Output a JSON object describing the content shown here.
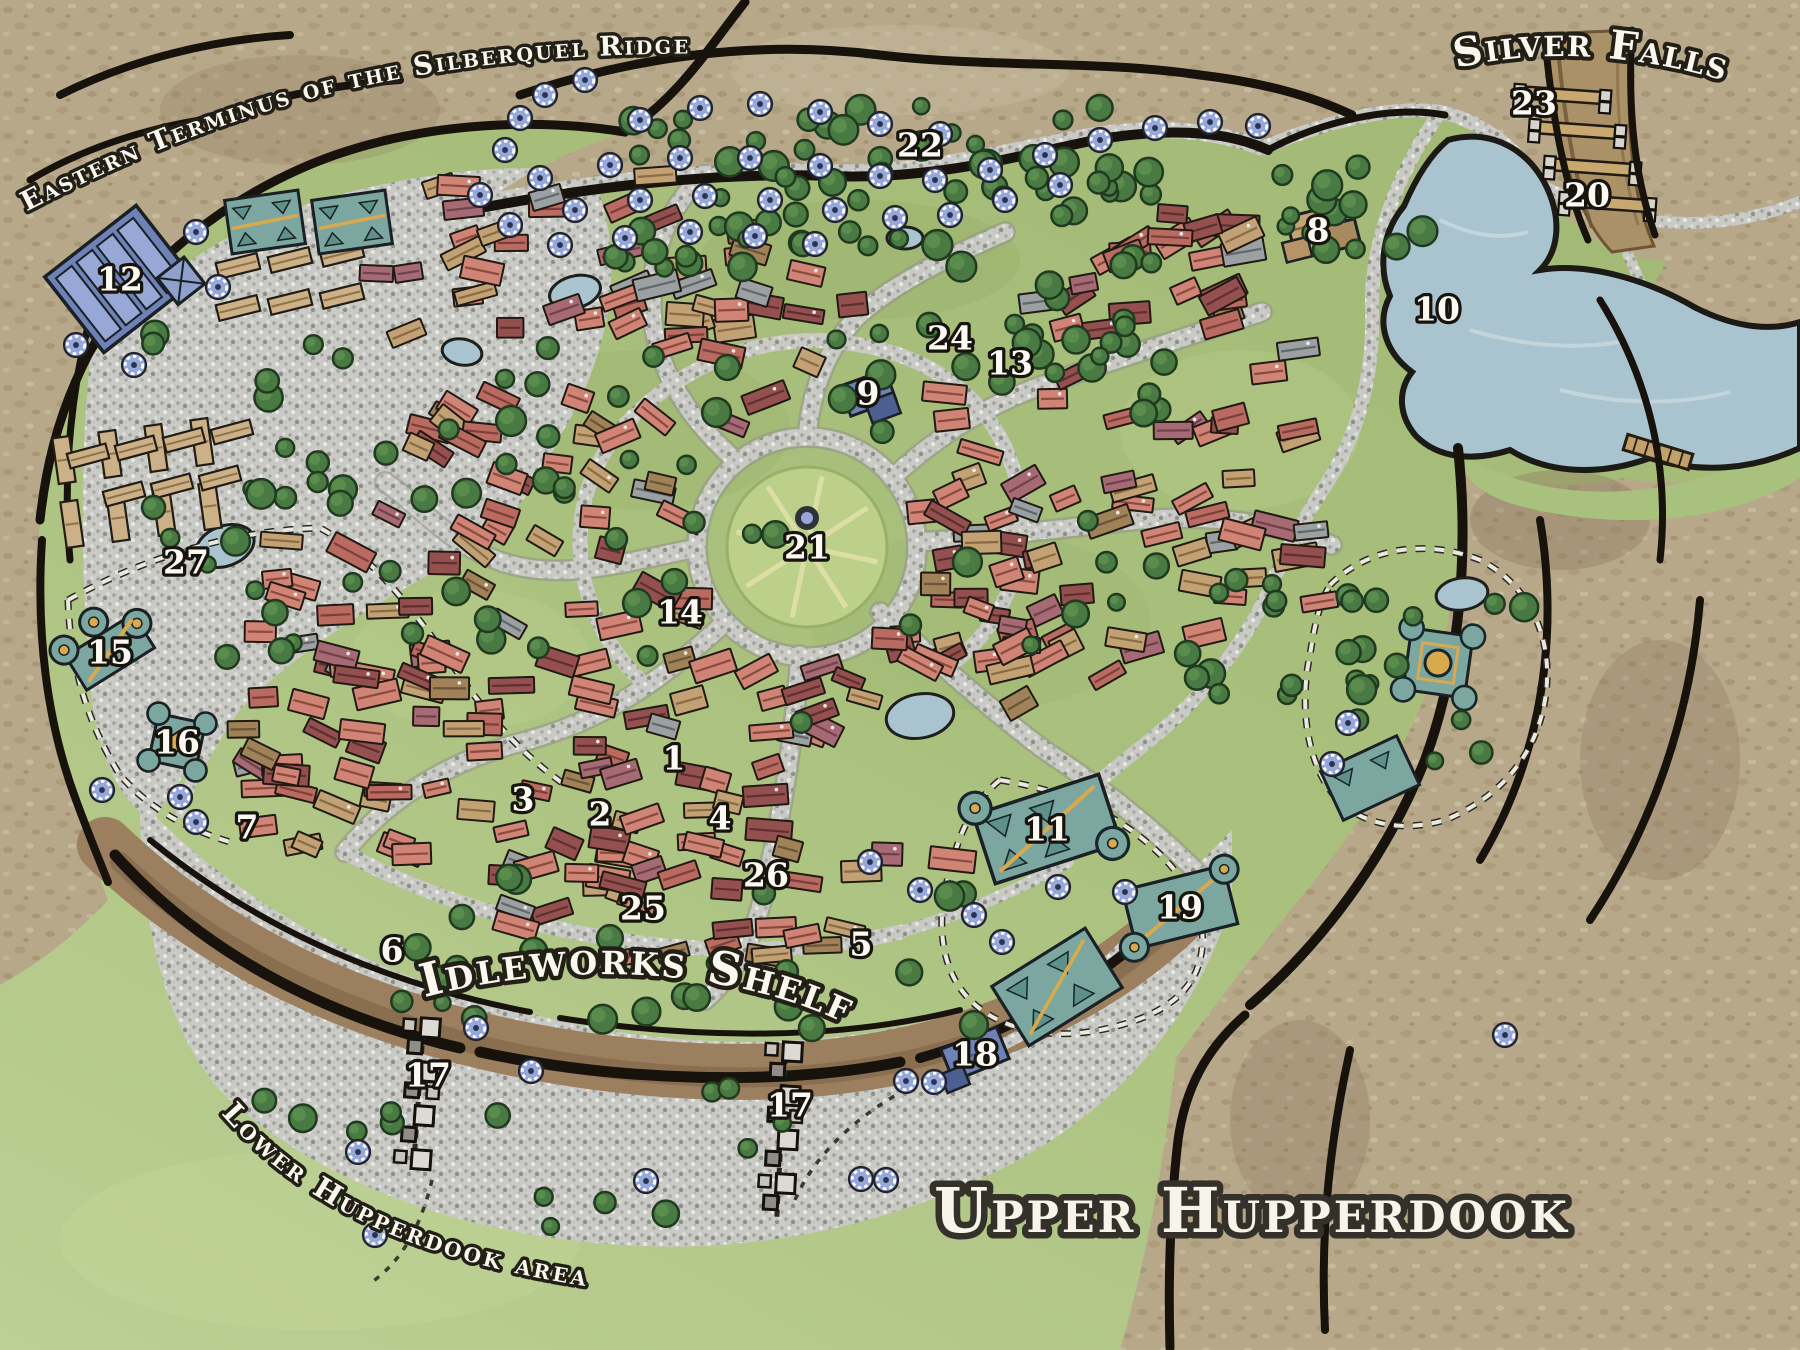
{
  "map": {
    "title": "Upper Hupperdook",
    "labels": {
      "eastern_terminus": "Eastern Terminus of the Silberquel Ridge",
      "silver_falls": "Silver Falls",
      "idleworks_shelf": "Idleworks Shelf",
      "lower_hupperdook": "Lower Hupperdook area"
    },
    "markers": [
      {
        "num": "1",
        "x": 674,
        "y": 758
      },
      {
        "num": "2",
        "x": 600,
        "y": 814
      },
      {
        "num": "3",
        "x": 523,
        "y": 799
      },
      {
        "num": "4",
        "x": 720,
        "y": 818
      },
      {
        "num": "5",
        "x": 861,
        "y": 944
      },
      {
        "num": "6",
        "x": 392,
        "y": 950
      },
      {
        "num": "7",
        "x": 247,
        "y": 827
      },
      {
        "num": "8",
        "x": 1318,
        "y": 230
      },
      {
        "num": "9",
        "x": 868,
        "y": 393
      },
      {
        "num": "10",
        "x": 1437,
        "y": 309
      },
      {
        "num": "11",
        "x": 1047,
        "y": 829
      },
      {
        "num": "12",
        "x": 120,
        "y": 279
      },
      {
        "num": "13",
        "x": 1010,
        "y": 363
      },
      {
        "num": "14",
        "x": 680,
        "y": 612
      },
      {
        "num": "15",
        "x": 110,
        "y": 652
      },
      {
        "num": "16",
        "x": 177,
        "y": 742
      },
      {
        "num": "17",
        "x": 428,
        "y": 1075
      },
      {
        "num": "17",
        "x": 790,
        "y": 1105
      },
      {
        "num": "18",
        "x": 975,
        "y": 1054
      },
      {
        "num": "19",
        "x": 1180,
        "y": 907
      },
      {
        "num": "20",
        "x": 1587,
        "y": 195
      },
      {
        "num": "21",
        "x": 807,
        "y": 547
      },
      {
        "num": "22",
        "x": 920,
        "y": 145
      },
      {
        "num": "23",
        "x": 1534,
        "y": 103
      },
      {
        "num": "24",
        "x": 950,
        "y": 338
      },
      {
        "num": "25",
        "x": 643,
        "y": 908
      },
      {
        "num": "26",
        "x": 766,
        "y": 875
      },
      {
        "num": "27",
        "x": 186,
        "y": 562
      }
    ],
    "colors": {
      "water": "#a9c4ce",
      "rock": "#b7a88a",
      "grass": "#a8c17c",
      "gravel": "#c9c9c5",
      "gear": "#96a7d9",
      "teal_building": "#7ba7a0",
      "blue_building": "#6f82b8",
      "label_fill": "#faf7ee",
      "label_stroke": "#221f17"
    }
  }
}
